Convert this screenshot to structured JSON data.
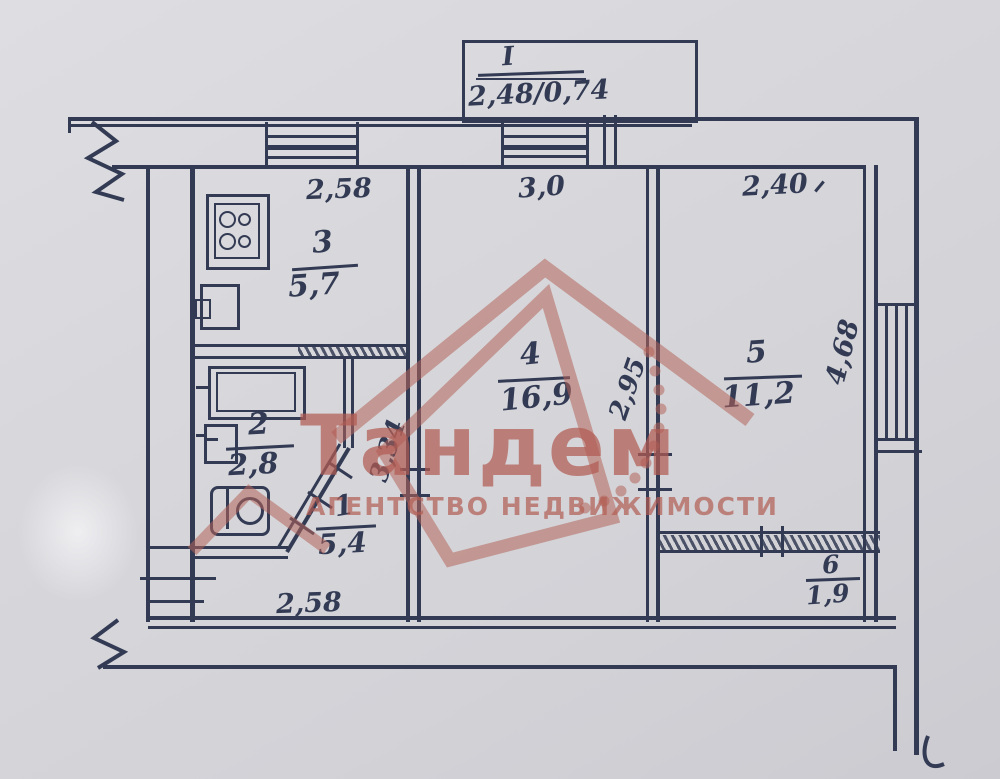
{
  "balcony": {
    "numeral": "I",
    "dims": "2,48/0,74"
  },
  "dims": {
    "kitchen_top": "2,58",
    "room4_top": "3,0",
    "room5_top": "2,40",
    "room5_right": "4,68",
    "room45_wall": "2,95",
    "hall_wall": "3,34",
    "bottom": "2,58"
  },
  "rooms": {
    "r1": {
      "num": "1",
      "area": "5,4"
    },
    "r2": {
      "num": "2",
      "area": "2,8"
    },
    "r3": {
      "num": "3",
      "area": "5,7"
    },
    "r4": {
      "num": "4",
      "area": "16,9"
    },
    "r5": {
      "num": "5",
      "area": "11,2"
    },
    "r6": {
      "num": "6",
      "area": "1,9"
    }
  },
  "watermark": {
    "brand": "Тандем",
    "subtitle": "АГЕНТСТВО НЕДВИЖИМОСТИ",
    "color": "#b25c52"
  },
  "colors": {
    "ink": "#333b54",
    "paper": "#d8d8dc"
  }
}
